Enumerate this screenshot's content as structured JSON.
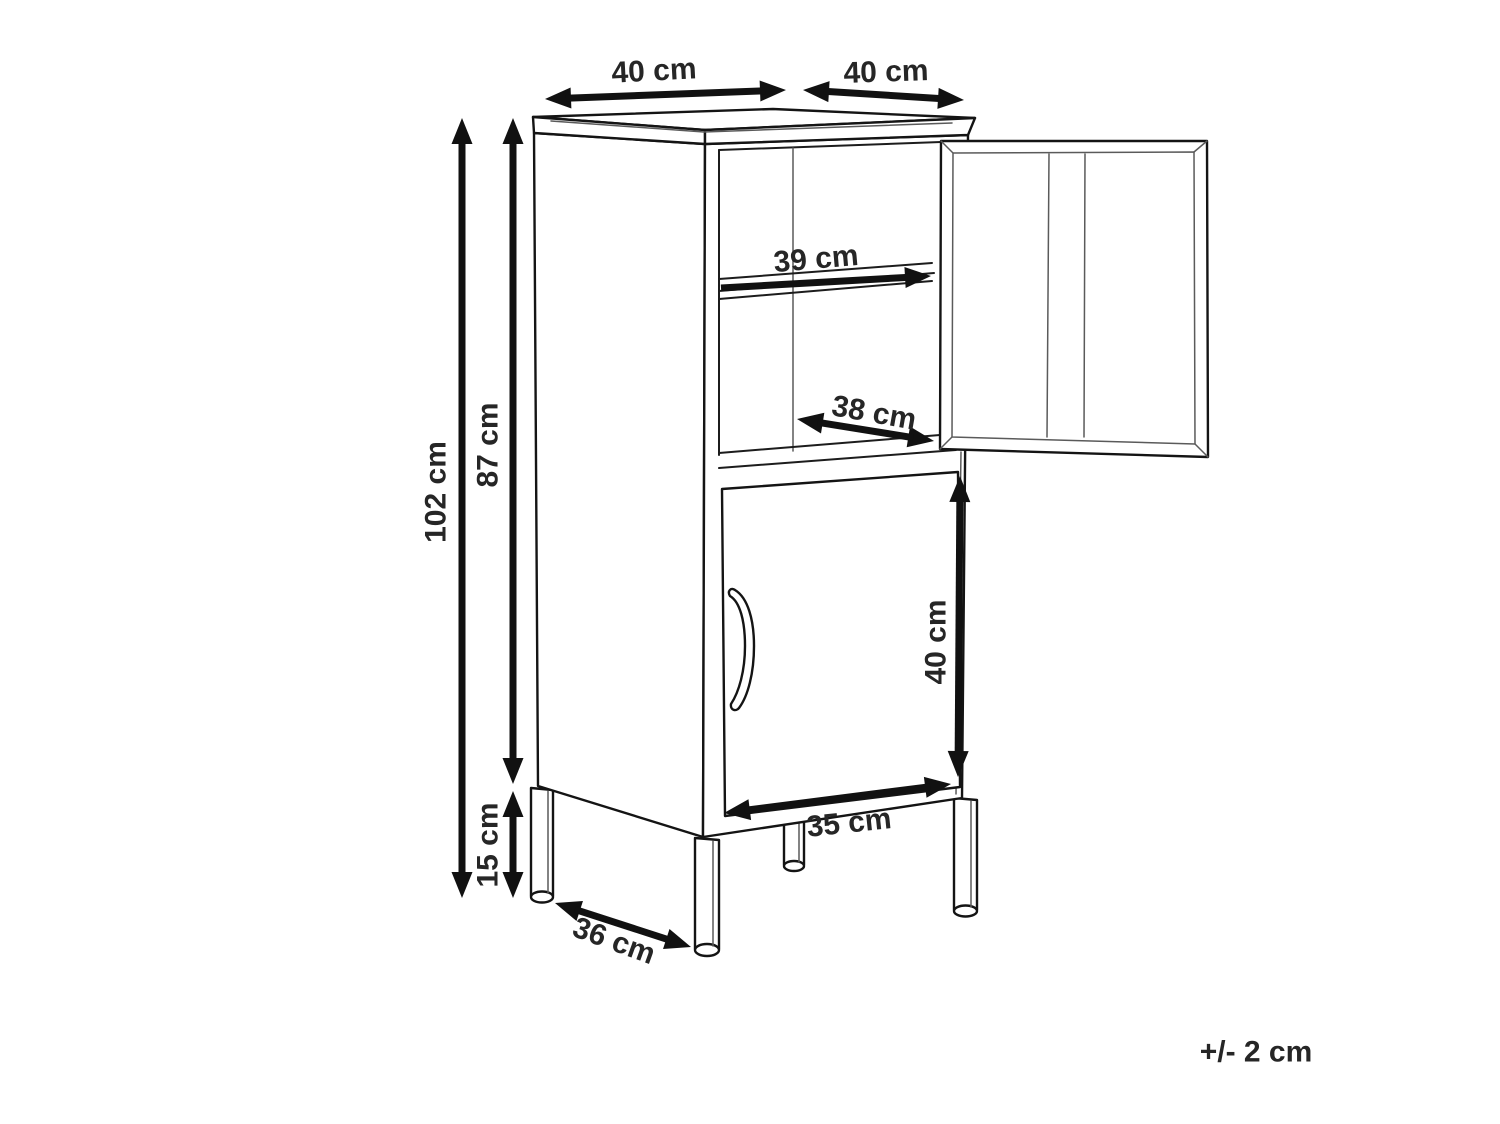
{
  "diagram": {
    "unit": "cm",
    "tolerance": "+/- 2 cm",
    "colors": {
      "line": "#141414",
      "arrow": "#111111",
      "text": "#262626",
      "background": "#ffffff"
    },
    "dims": {
      "top_depth": {
        "label": "40 cm",
        "value": 40
      },
      "top_width": {
        "label": "40 cm",
        "value": 40
      },
      "total_height": {
        "label": "102 cm",
        "value": 102
      },
      "body_height": {
        "label": "87 cm",
        "value": 87
      },
      "leg_height": {
        "label": "15 cm",
        "value": 15
      },
      "shelf_width": {
        "label": "39 cm",
        "value": 39
      },
      "inner_depth": {
        "label": "38 cm",
        "value": 38
      },
      "door_height": {
        "label": "40 cm",
        "value": 40
      },
      "door_width": {
        "label": "35 cm",
        "value": 35
      },
      "base_depth": {
        "label": "36 cm",
        "value": 36
      }
    }
  }
}
